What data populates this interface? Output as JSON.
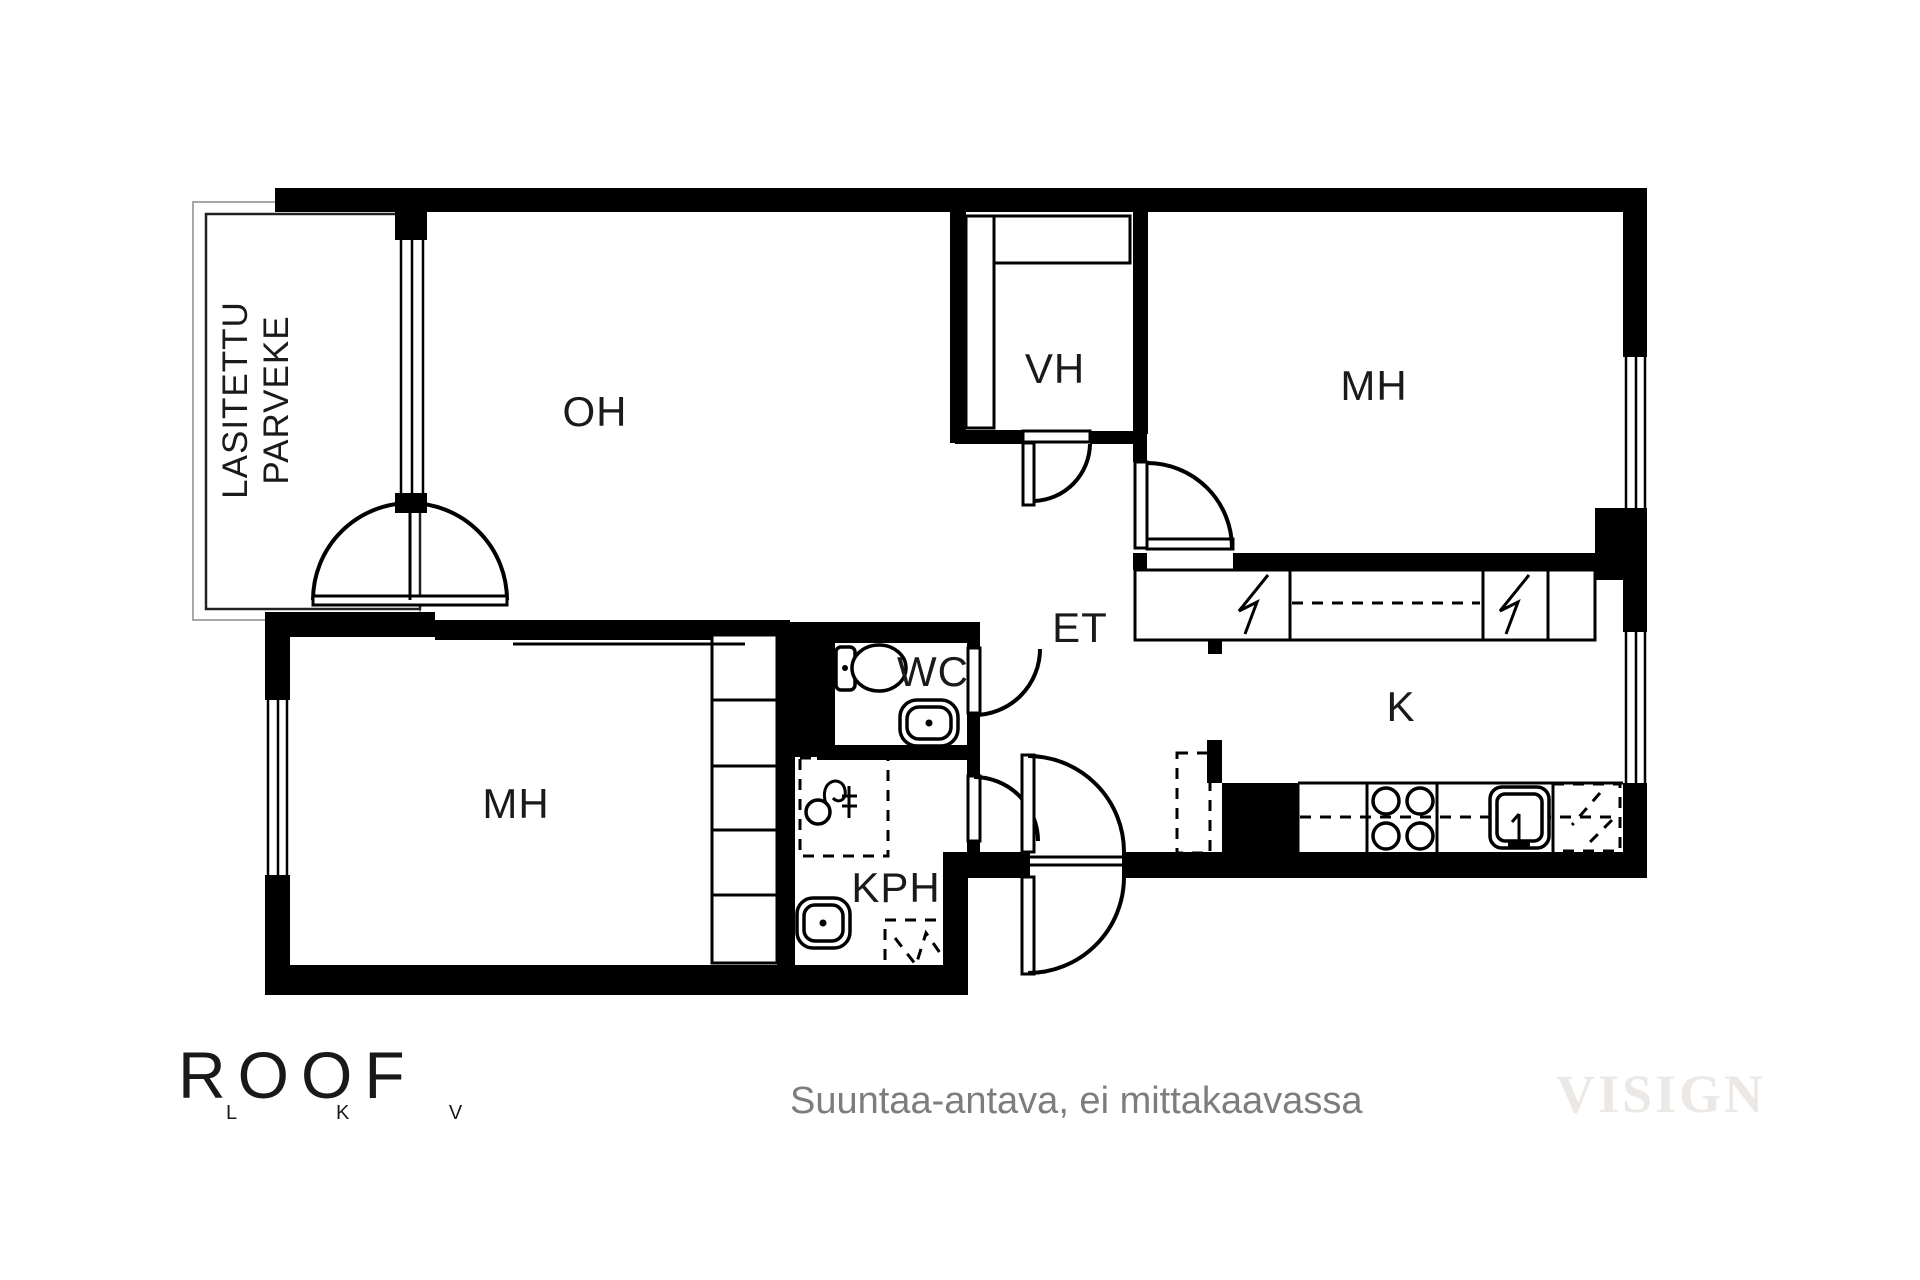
{
  "rooms": {
    "balcony_line1": "LASITETTU",
    "balcony_line2": "PARVEKE",
    "living": "OH",
    "closet": "VH",
    "bedroom_top": "MH",
    "bedroom_bottom": "MH",
    "wc": "WC",
    "entry": "ET",
    "kitchen": "K",
    "bathroom": "KPH"
  },
  "footer": {
    "note": "Suuntaa-antava, ei mittakaavassa",
    "watermark": "VISIGN"
  },
  "logo": {
    "name": "ROOF",
    "sub": "L K V"
  },
  "colors": {
    "wall": "#000000",
    "background": "#ffffff",
    "note_text": "#7d7d7d",
    "watermark": "#ebe8e5",
    "balcony_outline": "#a8a8a8"
  }
}
